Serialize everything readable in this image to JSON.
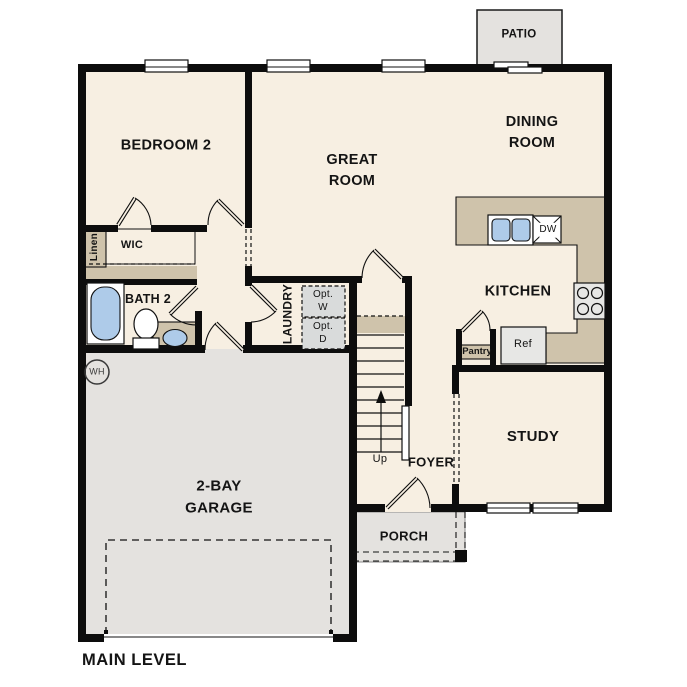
{
  "title": "MAIN LEVEL",
  "rooms": {
    "patio": "PATIO",
    "bedroom2": "BEDROOM 2",
    "great_room": "GREAT\nROOM",
    "dining_room": "DINING\nROOM",
    "kitchen": "KITCHEN",
    "study": "STUDY",
    "foyer": "FOYER",
    "porch": "PORCH",
    "garage": "2-BAY\nGARAGE",
    "bath2": "BATH 2",
    "laundry": "LAUNDRY",
    "wic": "WIC",
    "linen": "Linen"
  },
  "fixtures": {
    "pantry": "Pantry",
    "refrigerator": "Ref",
    "dishwasher": "DW",
    "optional_washer": "Opt.\nW",
    "optional_dryer": "Opt.\nD",
    "water_heater": "WH",
    "stairs_direction": "Up"
  },
  "colors": {
    "floor": "#f7efe2",
    "hard_floor": "#e4e2df",
    "counter": "#cfc3ab",
    "fixture_blue": "#aecbe9",
    "optional_box": "#d9dbdb",
    "wall": "#0d0d0d",
    "background": "#ffffff"
  }
}
